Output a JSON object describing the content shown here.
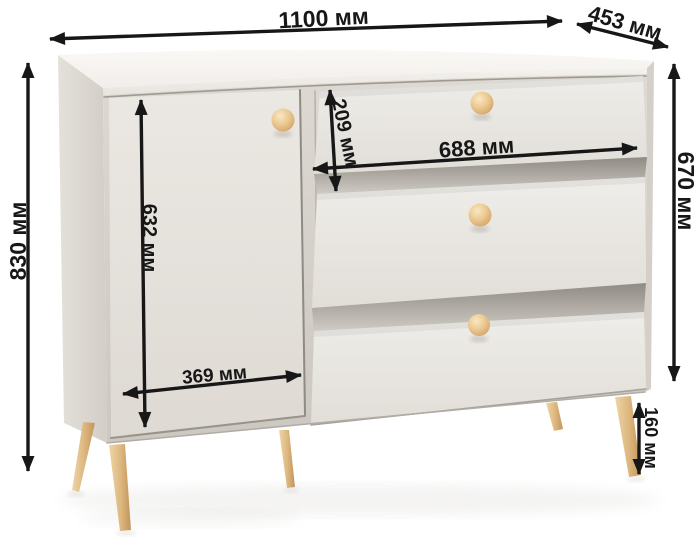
{
  "diagram": {
    "type": "furniture-dimensions",
    "product": "chest of drawers with door and 3 drawers",
    "unit": "мм"
  },
  "dimensions": {
    "width": "1100 мм",
    "depth": "453 мм",
    "height": "830 мм",
    "body_height": "670 мм",
    "leg_height": "160 мм",
    "door_height": "632 мм",
    "door_width": "369 мм",
    "top_drawer_height": "209 мм",
    "drawer_width": "688 мм"
  },
  "colors": {
    "dimension_lines": "#171717",
    "cabinet_body": "#e9e6e1",
    "cabinet_top": "#f6f4f0",
    "wood_accents": "#ddb77f",
    "background": "#ffffff"
  }
}
